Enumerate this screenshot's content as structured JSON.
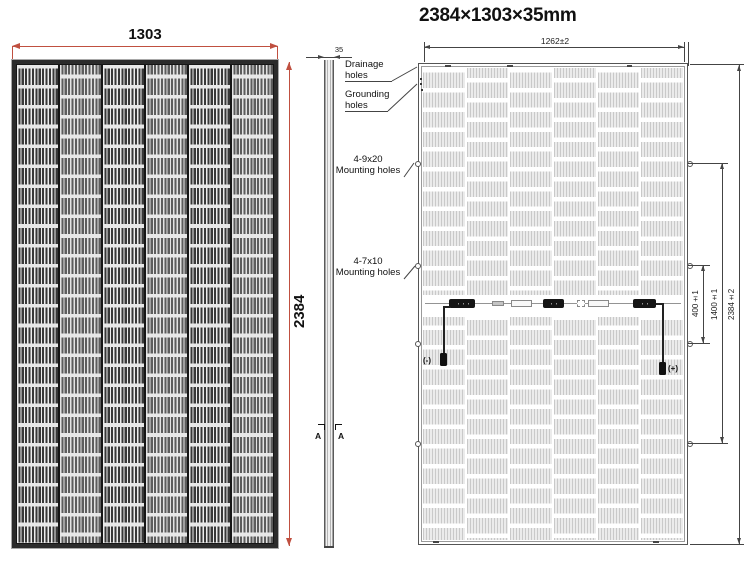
{
  "title": "2384×1303×35mm",
  "panels": {
    "columns": 6,
    "rows": 24
  },
  "front": {
    "width": "1303",
    "height": "2384"
  },
  "side": {
    "thickness": "35",
    "section_left": "A",
    "section_right": "A"
  },
  "back": {
    "glass_width": "1262±2",
    "dims": {
      "d400": "400±1",
      "d1400": "1400±1",
      "d2384": "2384±2"
    },
    "labels": {
      "drainage1": "Drainage",
      "drainage2": "holes",
      "grounding1": "Grounding",
      "grounding2": "holes",
      "m920_1": "4-9x20",
      "m920_2": "Mounting holes",
      "m710_1": "4-7x10",
      "m710_2": "Mounting holes"
    },
    "polarity": {
      "neg": "(-)",
      "pos": "(+)"
    }
  },
  "colors": {
    "dim_red": "#c05040",
    "line_gray": "#444444",
    "frame_dark": "#2b2b2b"
  }
}
